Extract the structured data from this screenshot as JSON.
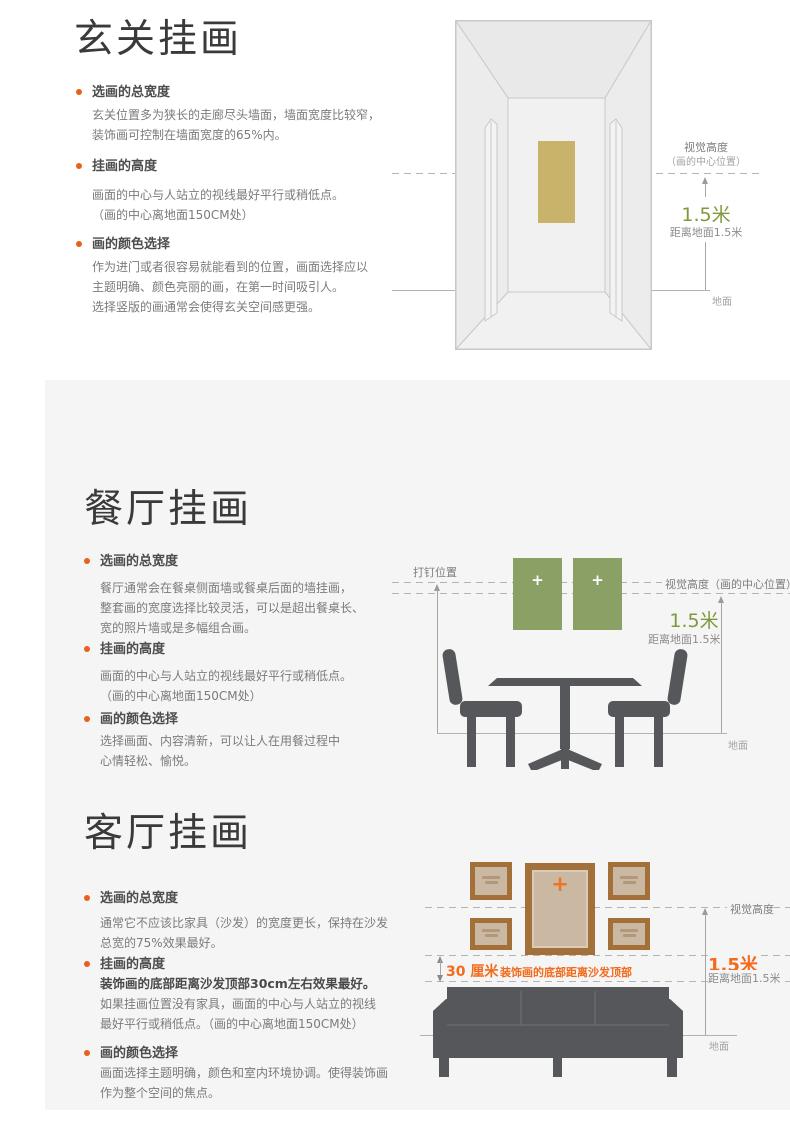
{
  "colors": {
    "accent_orange": "#e8611c",
    "measure_green": "#7e9a3d",
    "measure_orange": "#f26b1d",
    "frame_green": "#8ba064",
    "frame_brown": "#a4703a",
    "frame_inner_tan": "#cbb8a2",
    "painting_gold": "#c9b269",
    "furniture_gray": "#55575a",
    "panel_gray": "#f4f5f4"
  },
  "sections": {
    "entry": {
      "title": "玄关挂画",
      "bullets": [
        {
          "heading": "选画的总宽度",
          "lines": [
            "玄关位置多为狭长的走廊尽头墙面，墙面宽度比较窄，",
            "装饰画可控制在墙面宽度的65%内。"
          ]
        },
        {
          "heading": "挂画的高度",
          "lines": [
            "画面的中心与人站立的视线最好平行或稍低点。",
            "（画的中心离地面150CM处）"
          ]
        },
        {
          "heading": "画的颜色选择",
          "lines": [
            "作为进门或者很容易就能看到的位置，画面选择应以",
            "主题明确、颜色亮丽的画，在第一时间吸引人。",
            "选择竖版的画通常会使得玄关空间感更强。"
          ]
        }
      ],
      "annotations": {
        "visual_height": "视觉高度",
        "visual_height_sub": "（画的中心位置）",
        "height_value": "1.5米",
        "height_label": "距离地面1.5米",
        "ground": "地面"
      }
    },
    "dining": {
      "title": "餐厅挂画",
      "bullets": [
        {
          "heading": "选画的总宽度",
          "lines": [
            "餐厅通常会在餐桌侧面墙或餐桌后面的墙挂画，",
            "整套画的宽度选择比较灵活，可以是超出餐桌长、",
            "宽的照片墙或是多幅组合画。"
          ]
        },
        {
          "heading": "挂画的高度",
          "lines": [
            "画面的中心与人站立的视线最好平行或稍低点。",
            "（画的中心离地面150CM处）"
          ]
        },
        {
          "heading": "画的颜色选择",
          "lines": [
            "选择画面、内容清新，可以让人在用餐过程中",
            "心情轻松、愉悦。"
          ]
        }
      ],
      "annotations": {
        "nail_position": "打钉位置",
        "visual_height": "视觉高度（画的中心位置）",
        "height_value": "1.5米",
        "height_label": "距离地面1.5米",
        "ground": "地面",
        "frame_plus": "+"
      }
    },
    "living": {
      "title": "客厅挂画",
      "bullets": [
        {
          "heading": "选画的总宽度",
          "lines": [
            "通常它不应该比家具（沙发）的宽度更长，保持在沙发",
            "总宽的75%效果最好。"
          ]
        },
        {
          "heading": "挂画的高度",
          "bold_lines": [
            "装饰画的底部距离沙发顶部30cm左右效果最好。"
          ],
          "lines": [
            "如果挂画位置没有家具，画面的中心与人站立的视线",
            "最好平行或稍低点。（画的中心离地面150CM处）"
          ]
        },
        {
          "heading": "画的颜色选择",
          "lines": [
            "画面选择主题明确，颜色和室内环境协调。使得装饰画",
            "作为整个空间的焦点。"
          ]
        }
      ],
      "annotations": {
        "visual_height": "视觉高度",
        "height_value": "1.5米",
        "height_label": "距离地面1.5米",
        "ground": "地面",
        "gap_value": "30 厘米",
        "gap_label": "装饰画的底部距离沙发顶部",
        "frame_plus": "+"
      }
    }
  }
}
